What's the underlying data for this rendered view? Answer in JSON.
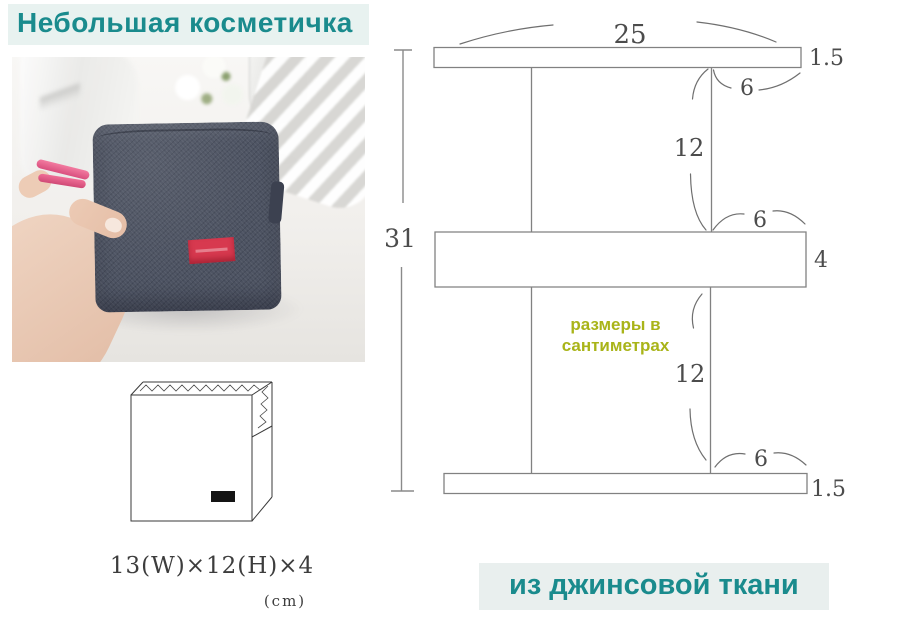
{
  "page": {
    "title": "Небольшая косметичка",
    "footer": "из джинсовой ткани"
  },
  "pattern": {
    "note_line1": "размеры в",
    "note_line2": "сантиметрах",
    "total_height": "31",
    "top_width": "25",
    "top_strip_height": "1.5",
    "top_corner": "6",
    "upper_section_height": "12",
    "mid_corner": "6",
    "middle_band_height": "4",
    "lower_section_height": "12",
    "bottom_corner": "6",
    "bottom_strip_height": "1.5"
  },
  "sketch": {
    "dimensions": "13(W)×12(H)×4",
    "unit": "(cm)"
  },
  "colors": {
    "accent_teal": "#1a8b8d",
    "caption_background": "#e8f2f0",
    "note_olive": "#a9b419",
    "diagram_line_gray": "#818181",
    "number_gray": "#4c4c4c",
    "bag_denim": "#4d5362",
    "bag_label_red": "#d7394f",
    "zipper_pink": "#e86090"
  }
}
